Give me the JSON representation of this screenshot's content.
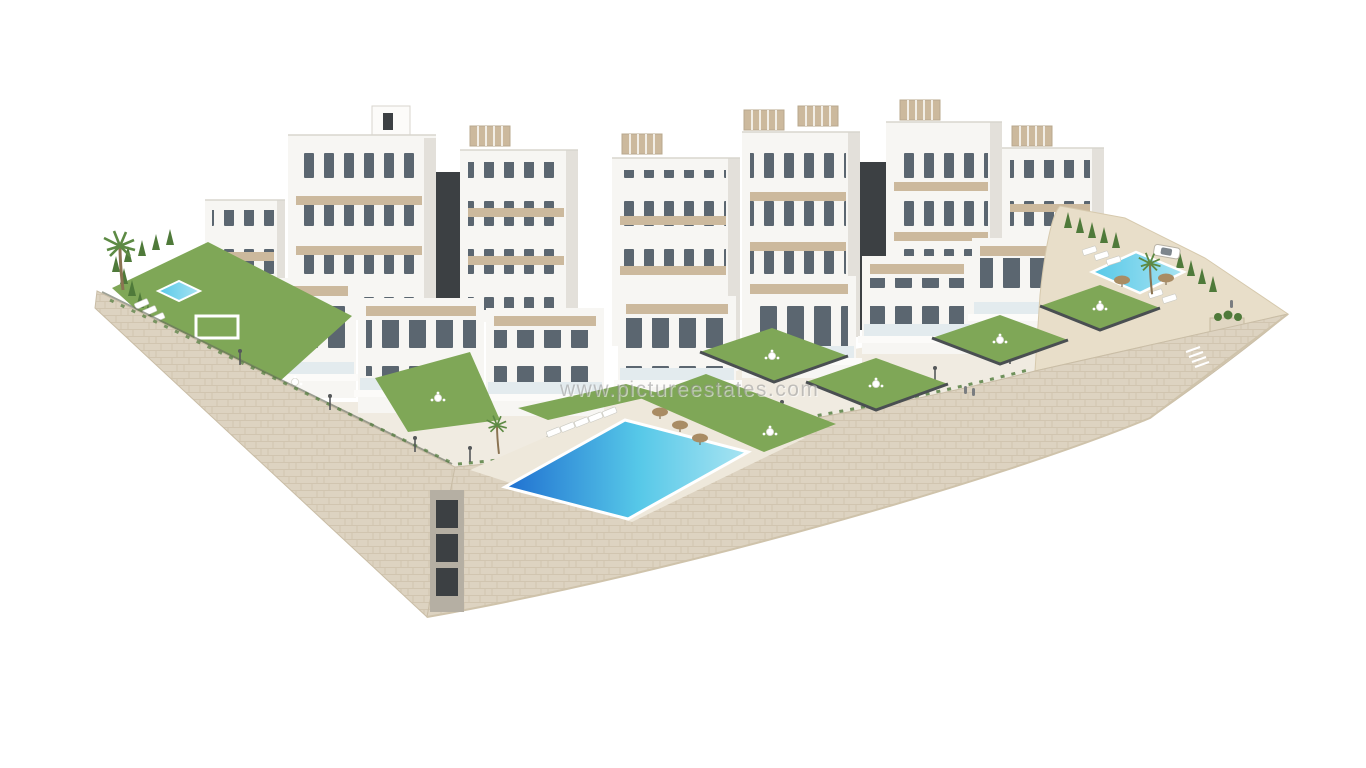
{
  "image": {
    "type": "3d-architectural-render",
    "subject": "Aerial 3D render of a modern white residential apartment complex with terraced gardens, rooftop pergolas and swimming pools on a stone-clad podium",
    "background": "white",
    "watermark": "www.pictureestates.com"
  },
  "scene": {
    "pools": [
      "main-community-pool",
      "left-garden-pool",
      "right-community-pool"
    ],
    "vehicles": [
      "white-car"
    ],
    "vegetation": [
      "palm-trees",
      "cypress-hedges",
      "lawn-terraces",
      "wall-greenery"
    ],
    "structures": [
      "apartment-blocks",
      "dark-feature-cores",
      "rooftop-pergolas",
      "stone-retaining-wall",
      "street-lamps",
      "sun-loungers",
      "parasols"
    ]
  },
  "colors": {
    "background": "#ffffff",
    "building_white": "#f7f6f3",
    "building_shadow": "#e3e0da",
    "accent_beige": "#ccb99d",
    "dark_feature": "#3c4043",
    "window_glass": "#5b6670",
    "glass_railing": "#dfe9ec",
    "grass_green": "#7fa757",
    "grass_dark": "#6c9449",
    "pool_deep_blue": "#1f6fd0",
    "pool_turquoise": "#56c8e8",
    "pool_light": "#a9e4f2",
    "stone_wall": "#ddd3c1",
    "stone_joint": "#c6b9a2",
    "sand_terrain": "#e8dec9",
    "parasol_tan": "#a98c64",
    "cypress_green": "#4f7a3a",
    "palm_green": "#5d8a44"
  }
}
